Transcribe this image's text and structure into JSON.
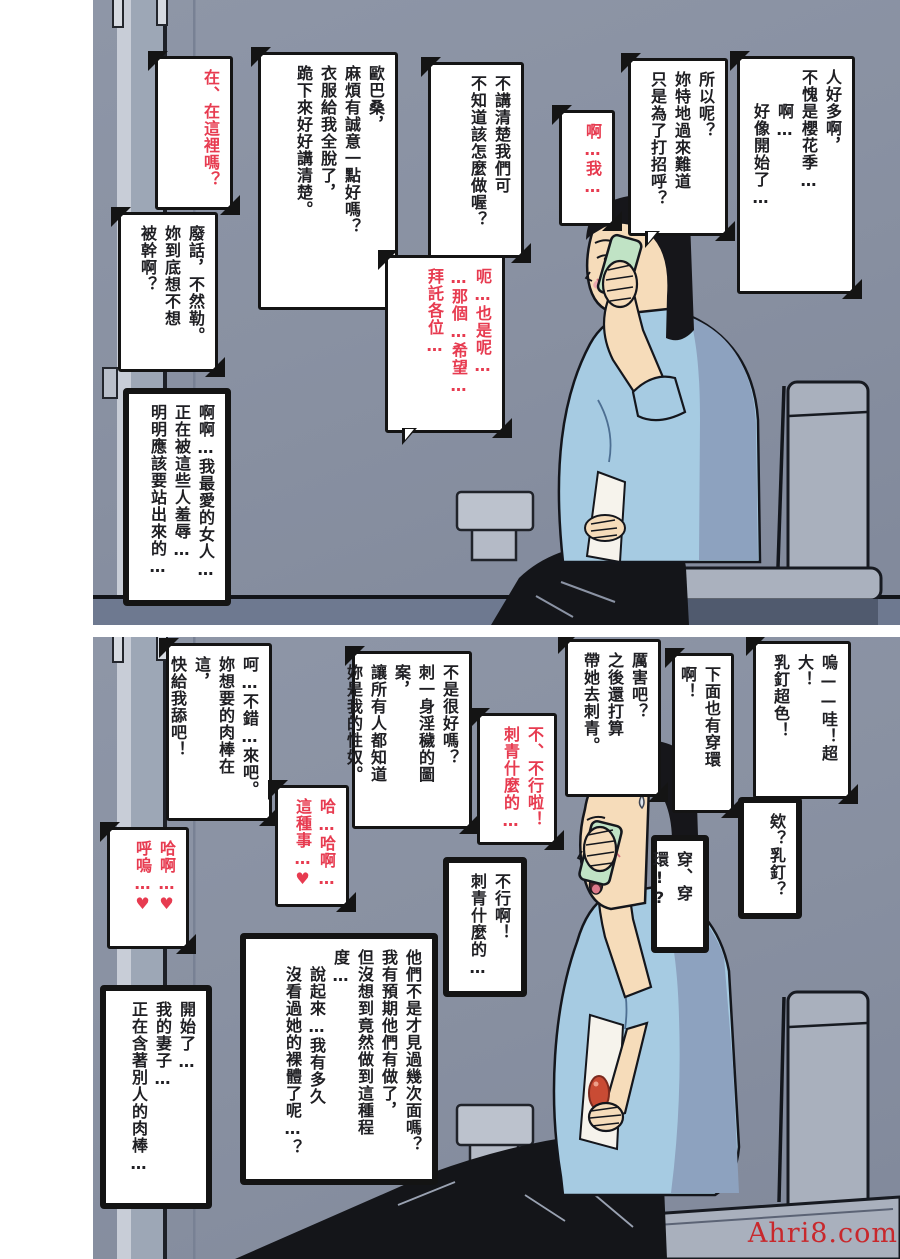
{
  "watermark": "Ahri8.com",
  "colors": {
    "wall": "#8a92a4",
    "floor": "#6e7990",
    "fixture_gray": "#a9b0bd",
    "shirt_blue": "#a6cbe2",
    "shirt_shadow": "#8da2bf",
    "skin": "#f6dcba",
    "hair": "#16161a",
    "phone_green": "#c0e3c5",
    "pants": "#141519",
    "black_text": "#1f1f23",
    "red_text": "#e73b50",
    "watermark_red": "#c8282c"
  },
  "panel1": {
    "bubbles": [
      {
        "id": "crowd",
        "tone": "black",
        "text": "人好多啊，\n不愧是櫻花季…\n　　啊…\n　　好像開始了…"
      },
      {
        "id": "so-what",
        "tone": "black",
        "text": "所以呢？\n妳特地過來難道\n只是為了打招呼？"
      },
      {
        "id": "ah-me",
        "tone": "red",
        "text": "啊…我…"
      },
      {
        "id": "speak-clearly",
        "tone": "black",
        "text": "不講清楚我們可\n不知道該怎麼做喔？"
      },
      {
        "id": "obasan",
        "tone": "black",
        "text": "歐巴桑，\n麻煩有誠意一點好嗎？\n衣服給我全脫了，\n跪下來好好講清楚。"
      },
      {
        "id": "here",
        "tone": "red",
        "text": "在、在這裡嗎？"
      },
      {
        "id": "nonsense",
        "tone": "black",
        "text": "廢話，不然勒。\n妳到底想不想\n被幹啊？"
      },
      {
        "id": "please-everyone",
        "tone": "red",
        "text": "呃…也是呢…\n…那個…希望…\n拜託各位…"
      },
      {
        "id": "beloved",
        "tone": "black",
        "text": "啊啊…我最愛的女人…\n正在被這些人羞辱…\n明明應該要站出來的…"
      }
    ]
  },
  "panel2": {
    "bubbles": [
      {
        "id": "piercing-wow",
        "tone": "black",
        "text": "嗚——哇！超大！\n乳釘超色！"
      },
      {
        "id": "below-too",
        "tone": "black",
        "text": "下面也有穿環啊！"
      },
      {
        "id": "tattoo-plan",
        "tone": "black",
        "text": "厲害吧？\n之後還打算\n帶她去刺青。"
      },
      {
        "id": "sex-slave",
        "tone": "black",
        "text": "不是很好嗎？\n刺一身淫穢的圖案，\n讓所有人都知道\n妳是我的性奴。"
      },
      {
        "id": "no-tattoo-red",
        "tone": "red",
        "text": "不、不行啦！\n刺青什麼的…"
      },
      {
        "id": "no-tattoo-think",
        "tone": "black",
        "text": "不行啊！\n刺青什麼的…"
      },
      {
        "id": "eh-piercing",
        "tone": "black",
        "text": "欸？乳釘？"
      },
      {
        "id": "pierced",
        "tone": "black",
        "text": "穿、穿環!?"
      },
      {
        "id": "lick",
        "tone": "black",
        "text": "呵…不錯…來吧。\n妳想要的肉棒在這，\n快給我舔吧！"
      },
      {
        "id": "haha-heart",
        "tone": "red",
        "text": "哈…哈啊…\n這種事…♥"
      },
      {
        "id": "haa-heart",
        "tone": "red",
        "text": "哈啊…♥\n呼嗚…♥"
      },
      {
        "id": "how-far",
        "tone": "black",
        "text": "他們不是才見過幾次面嗎？\n我有預期他們有做了，\n但沒想到竟然做到這種程度…\n　說起來…我有多久\n　沒看過她的裸體了呢…？"
      },
      {
        "id": "started",
        "tone": "black",
        "text": "開始了…\n我的妻子…\n正在含著別人的肉棒…"
      }
    ]
  }
}
